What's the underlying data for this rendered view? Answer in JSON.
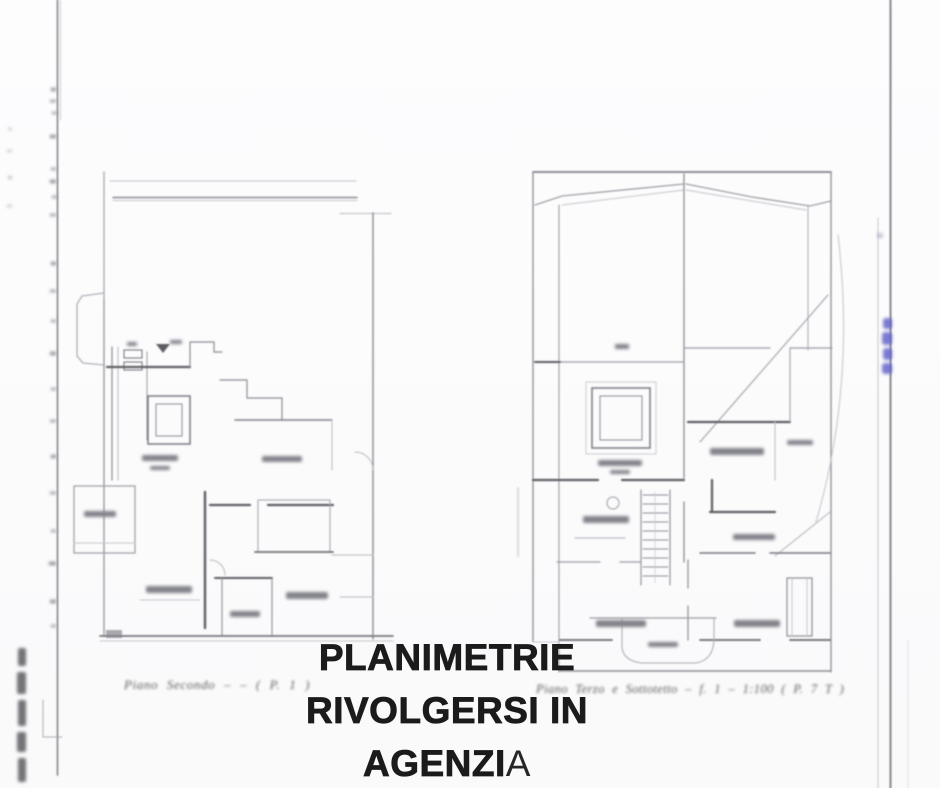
{
  "overlay": {
    "line1": "PLANIMETRIE",
    "line2": "RIVOLGERSI IN",
    "line3_bold": "AGENZI",
    "line3_regular": "A"
  },
  "plans": {
    "left": {
      "caption": "Piano Secondo ‒ ‒ ( P. 1 )"
    },
    "right": {
      "caption": "Piano Terzo e Sottotetto ‒ f. 1 ‒ 1:100 ( P. 7 T )"
    }
  },
  "colors": {
    "background": "#fbfbfc",
    "plan_line": "#8a8a92",
    "plan_line_dark": "#5d5d64",
    "plan_line_light": "#b8b8c0",
    "margin_line": "#6e6e76",
    "overlay_text": "#1b1b1b",
    "blue_annotation": "#5b5bc8"
  }
}
